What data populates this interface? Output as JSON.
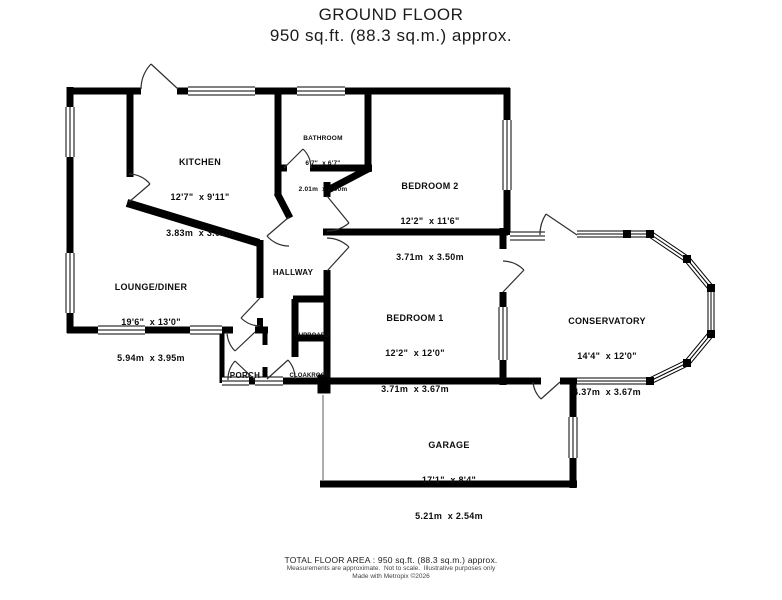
{
  "title": {
    "line1": "GROUND FLOOR",
    "line2": "950 sq.ft. (88.3 sq.m.) approx."
  },
  "rooms": {
    "kitchen": {
      "name": "KITCHEN",
      "imperial": "12'7\"  x 9'11\"",
      "metric": "3.83m  x 3.02m"
    },
    "bathroom": {
      "name": "BATHROOM",
      "imperial": "6'7\"  x 6'7\"",
      "metric": "2.01m  x 2.00m"
    },
    "bedroom2": {
      "name": "BEDROOM 2",
      "imperial": "12'2\"  x 11'6\"",
      "metric": "3.71m  x 3.50m"
    },
    "lounge": {
      "name": "LOUNGE/DINER",
      "imperial": "19'6\"  x 13'0\"",
      "metric": "5.94m  x 3.95m"
    },
    "hallway": {
      "name": "HALLWAY"
    },
    "bedroom1": {
      "name": "BEDROOM 1",
      "imperial": "12'2\"  x 12'0\"",
      "metric": "3.71m  x 3.67m"
    },
    "conservatory": {
      "name": "CONSERVATORY",
      "imperial": "14'4\"  x 12'0\"",
      "metric": "4.37m  x 3.67m"
    },
    "cupboard": {
      "name": "CUPBOARD"
    },
    "cloakroom": {
      "name": "CLOAKROOM"
    },
    "porch": {
      "name": "PORCH"
    },
    "garage": {
      "name": "GARAGE",
      "imperial": "17'1\"  x 8'4\"",
      "metric": "5.21m  x 2.54m"
    }
  },
  "footer": {
    "line1": "TOTAL FLOOR AREA : 950 sq.ft. (88.3 sq.m.) approx.",
    "line2": "Measurements are approximate.  Not to scale.  Illustrative purposes only",
    "line3": "Made with Metropix ©2026"
  },
  "colors": {
    "wall": "#000000",
    "window": "#000000",
    "door_arc": "#2f2f2f",
    "garage_front_line": "#8a8a8a",
    "background": "#ffffff",
    "text": "#111111"
  }
}
